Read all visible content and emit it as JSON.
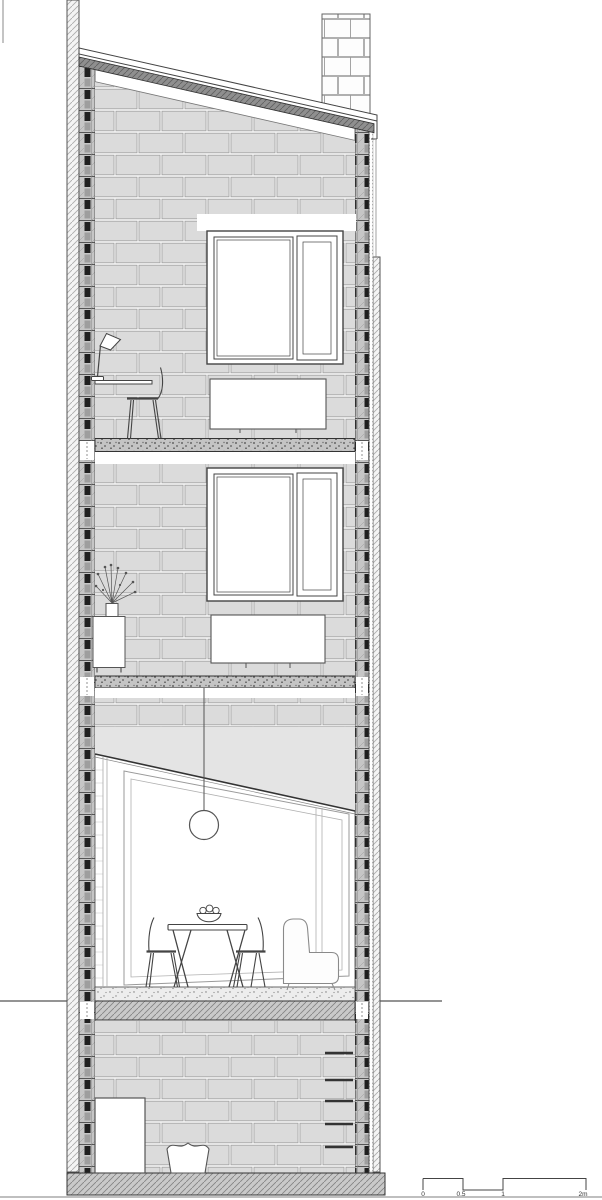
{
  "drawing": {
    "kind": "architectural cross-section of a narrow terraced house",
    "legend_names": [
      "party-wall-left",
      "party-wall-right",
      "pitched-roof",
      "chimney",
      "blockwork-face",
      "study-window",
      "study-radiator",
      "desk",
      "desk-lamp",
      "desk-chair",
      "bedroom-window",
      "bedroom-radiator",
      "sideboard",
      "vase-of-flowers",
      "sloped-ceiling",
      "pendant-lamp",
      "dining-table",
      "fruit-bowl",
      "dining-chair",
      "lounge-chair",
      "washing-machine",
      "laundry-basket",
      "wall-ladder",
      "ground-line",
      "ground-slab",
      "basement-slab",
      "scale-bar"
    ]
  },
  "scale_bar": {
    "labels": [
      "0",
      "0.5",
      "1",
      "2m"
    ]
  },
  "colors": {
    "background": "#ffffff",
    "line": "#444444",
    "block_fill": "#dbdbdb",
    "mortar": "#f2f2f2",
    "cut_dark": "#1f1f1f",
    "roof_insulation_grey": "#8f8f8f",
    "ceiling_poche": "#e4e4e4",
    "slab_grey": "#c9c9c9",
    "hatch_line": "#adadad"
  }
}
